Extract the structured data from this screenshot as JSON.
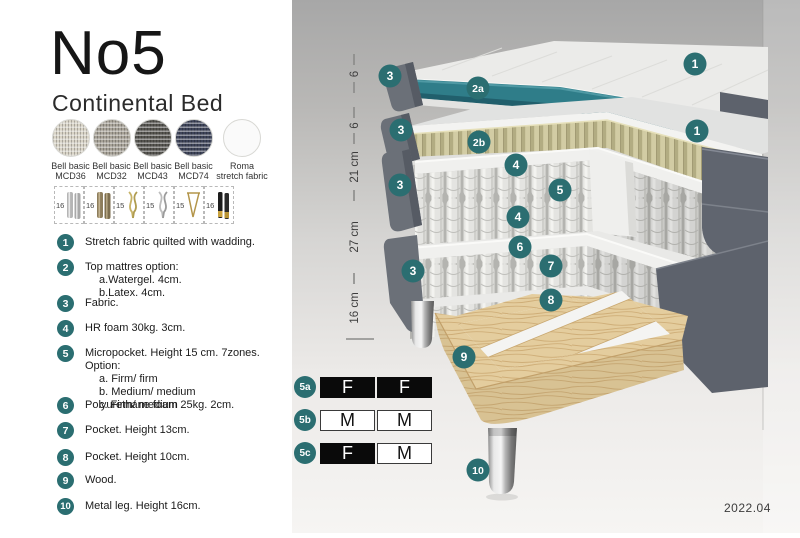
{
  "header": {
    "title": "No5",
    "subtitle": "Continental Bed"
  },
  "fabrics": [
    {
      "line1": "Bell basic",
      "line2": "MCD36",
      "color": "#d8d3c6"
    },
    {
      "line1": "Bell basic",
      "line2": "MCD32",
      "color": "#a6a196"
    },
    {
      "line1": "Bell basic",
      "line2": "MCD43",
      "color": "#565550"
    },
    {
      "line1": "Bell basic",
      "line2": "MCD74",
      "color": "#3e4459"
    },
    {
      "line1": "Roma",
      "line2": "stretch fabric",
      "color": "#fafafa"
    }
  ],
  "legs": [
    {
      "size": "16",
      "type": "cylinder-silver"
    },
    {
      "size": "16",
      "type": "cylinder-bronze"
    },
    {
      "size": "15",
      "type": "twisted-gold"
    },
    {
      "size": "15",
      "type": "twisted-silver"
    },
    {
      "size": "15",
      "type": "hairpin-gold"
    },
    {
      "size": "16",
      "type": "cylinder-black-gold"
    }
  ],
  "spec_list": [
    {
      "num": "1",
      "text": "Stretch fabric quilted with wadding."
    },
    {
      "num": "2",
      "text": "Top mattres option:",
      "sub": [
        "a.Watergel. 4cm.",
        "b.Latex. 4cm."
      ]
    },
    {
      "num": "3",
      "text": "Fabric."
    },
    {
      "num": "4",
      "text": "HR foam 30kg. 3cm."
    },
    {
      "num": "5",
      "text": "Micropocket. Height 15 cm. 7zones. Option:",
      "sub": [
        "a. Firm/ firm",
        "b. Medium/ medium",
        "c. Firm/ medium"
      ]
    },
    {
      "num": "6",
      "text": "Polyurethane foam 25kg. 2cm."
    },
    {
      "num": "7",
      "text": "Pocket. Height 13cm."
    },
    {
      "num": "8",
      "text": "Pocket. Height 10cm."
    },
    {
      "num": "9",
      "text": "Wood."
    },
    {
      "num": "10",
      "text": "Metal leg. Height 16cm."
    }
  ],
  "diagram": {
    "ruler": [
      "6",
      "6",
      "21 cm",
      "27 cm",
      "16 cm"
    ],
    "callouts": [
      {
        "id": "1a",
        "label": "1"
      },
      {
        "id": "3a",
        "label": "3"
      },
      {
        "id": "2a",
        "label": "2a"
      },
      {
        "id": "3b",
        "label": "3"
      },
      {
        "id": "2b",
        "label": "2b"
      },
      {
        "id": "1b",
        "label": "1"
      },
      {
        "id": "4a",
        "label": "4"
      },
      {
        "id": "5",
        "label": "5"
      },
      {
        "id": "3c",
        "label": "3"
      },
      {
        "id": "4b",
        "label": "4"
      },
      {
        "id": "6",
        "label": "6"
      },
      {
        "id": "7",
        "label": "7"
      },
      {
        "id": "3d",
        "label": "3"
      },
      {
        "id": "8",
        "label": "8"
      },
      {
        "id": "9",
        "label": "9"
      },
      {
        "id": "10",
        "label": "10"
      }
    ],
    "version": "2022.04"
  },
  "firmness": [
    {
      "id": "5a",
      "left": "F",
      "right": "F"
    },
    {
      "id": "5b",
      "left": "M",
      "right": "M"
    },
    {
      "id": "5c",
      "left": "F",
      "right": "M"
    }
  ],
  "colors": {
    "accent_teal": "#2b6e71",
    "watergel_teal": "#2f7d89",
    "latex_tan": "#cfc9a0",
    "fabric_grey": "#6b7078",
    "wood": "#e3cc9c"
  }
}
